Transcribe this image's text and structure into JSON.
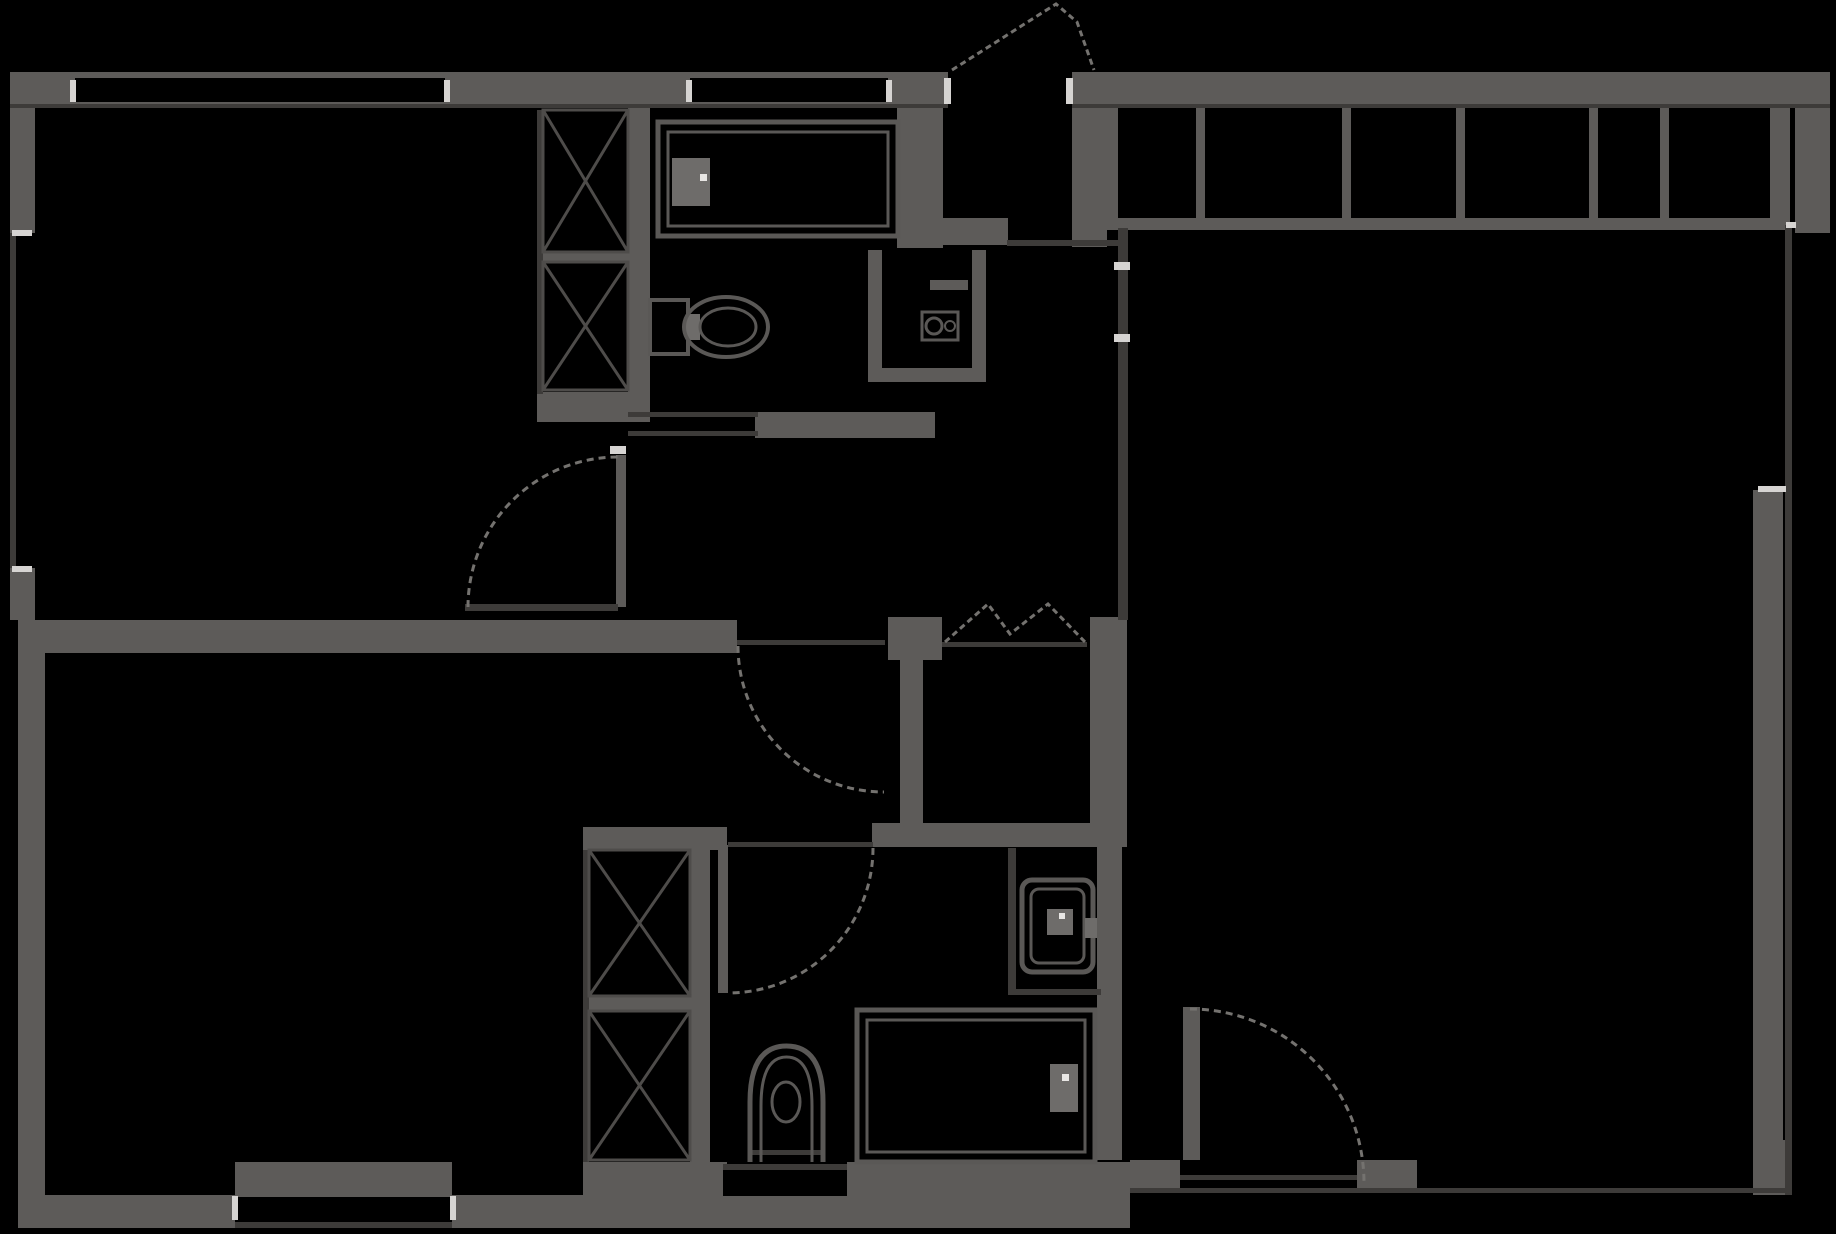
{
  "canvas": {
    "width": 1836,
    "height": 1234,
    "background": "#000000"
  },
  "palette": {
    "bg": "#000000",
    "wall": "#5d5b59",
    "line": "#3d3b39",
    "dash": "#74726f",
    "tick": "#d6d4d2",
    "fix": "#5a5856",
    "fixFill": "#6e6c6a",
    "dot": "#e8e6e4"
  },
  "elements": [
    {
      "name": "top-wall",
      "kind": "wall",
      "r": [
        10,
        72,
        1820,
        36
      ]
    },
    {
      "name": "left-wall-upper",
      "kind": "wall",
      "r": [
        10,
        72,
        25,
        161
      ]
    },
    {
      "name": "left-wall-mid",
      "kind": "wall",
      "r": [
        10,
        568,
        25,
        52
      ]
    },
    {
      "name": "left-wall-lower",
      "kind": "wall",
      "r": [
        18,
        620,
        27,
        608
      ]
    },
    {
      "name": "right-wall-upper",
      "kind": "wall",
      "r": [
        1795,
        72,
        35,
        161
      ]
    },
    {
      "name": "right-wall-lower",
      "kind": "wall",
      "r": [
        1753,
        490,
        30,
        705
      ]
    },
    {
      "name": "bottom-wall-left",
      "kind": "wall",
      "r": [
        18,
        1195,
        217,
        33
      ]
    },
    {
      "name": "bottom-wall-window-band",
      "kind": "wall",
      "r": [
        235,
        1162,
        217,
        35
      ]
    },
    {
      "name": "bottom-wall-2",
      "kind": "wall",
      "r": [
        452,
        1195,
        131,
        33
      ]
    },
    {
      "name": "bottom-wall-closet-band",
      "kind": "wall",
      "r": [
        583,
        1162,
        144,
        66
      ]
    },
    {
      "name": "bottom-wall-under-bath-window",
      "kind": "wall",
      "r": [
        723,
        1196,
        124,
        32
      ]
    },
    {
      "name": "bottom-wall-3",
      "kind": "wall",
      "r": [
        847,
        1162,
        283,
        66
      ]
    },
    {
      "name": "patio-block-left",
      "kind": "wall",
      "r": [
        1130,
        1160,
        50,
        33
      ]
    },
    {
      "name": "patio-block-right",
      "kind": "wall",
      "r": [
        1357,
        1160,
        60,
        33
      ]
    },
    {
      "name": "bottom-corner-right",
      "kind": "wall",
      "r": [
        1753,
        1140,
        37,
        55
      ]
    },
    {
      "name": "mid-dividing-wall",
      "kind": "wall",
      "r": [
        35,
        620,
        702,
        33
      ]
    },
    {
      "name": "closet-top-left-bottom-wall",
      "kind": "wall",
      "r": [
        537,
        392,
        100,
        30
      ]
    },
    {
      "name": "bath-top-left-wall",
      "kind": "wall",
      "r": [
        628,
        108,
        22,
        314
      ]
    },
    {
      "name": "bath-top-right-wall",
      "kind": "wall",
      "r": [
        897,
        108,
        46,
        140
      ]
    },
    {
      "name": "bath-top-bottom-wall",
      "kind": "wall",
      "r": [
        755,
        412,
        180,
        26
      ]
    },
    {
      "name": "vestibule-left-wall",
      "kind": "wall",
      "r": [
        930,
        98,
        13,
        147
      ]
    },
    {
      "name": "vestibule-right-wall",
      "kind": "wall",
      "r": [
        1072,
        85,
        35,
        162
      ]
    },
    {
      "name": "vestibule-bottom-wall",
      "kind": "wall",
      "r": [
        930,
        218,
        78,
        27
      ]
    },
    {
      "name": "closet-row-bottom-wall",
      "kind": "wall",
      "r": [
        1107,
        218,
        683,
        12
      ]
    },
    {
      "name": "closet-row-left-edge",
      "kind": "wall",
      "r": [
        1107,
        108,
        11,
        112
      ]
    },
    {
      "name": "closet-row-divider-1",
      "kind": "wall",
      "r": [
        1196,
        108,
        9,
        112
      ]
    },
    {
      "name": "closet-row-divider-2",
      "kind": "wall",
      "r": [
        1342,
        108,
        9,
        112
      ]
    },
    {
      "name": "closet-row-divider-3",
      "kind": "wall",
      "r": [
        1456,
        108,
        9,
        112
      ]
    },
    {
      "name": "closet-row-divider-4",
      "kind": "wall",
      "r": [
        1589,
        108,
        9,
        112
      ]
    },
    {
      "name": "closet-row-divider-5",
      "kind": "wall",
      "r": [
        1660,
        108,
        9,
        112
      ]
    },
    {
      "name": "closet-row-end-block",
      "kind": "wall",
      "r": [
        1770,
        108,
        20,
        112
      ]
    },
    {
      "name": "wc-left-wall",
      "kind": "wall",
      "r": [
        868,
        250,
        14,
        132
      ]
    },
    {
      "name": "wc-right-wall",
      "kind": "wall",
      "r": [
        972,
        250,
        14,
        132
      ]
    },
    {
      "name": "wc-bottom-wall",
      "kind": "wall",
      "r": [
        868,
        368,
        118,
        14
      ]
    },
    {
      "name": "wc-top-stub",
      "kind": "wall",
      "r": [
        930,
        280,
        38,
        10
      ]
    },
    {
      "name": "wic-left-wall",
      "kind": "wall",
      "r": [
        900,
        617,
        23,
        230
      ]
    },
    {
      "name": "wic-top-left-block",
      "kind": "wall",
      "r": [
        888,
        617,
        54,
        43
      ]
    },
    {
      "name": "wic-right-wall",
      "kind": "wall",
      "r": [
        1090,
        617,
        37,
        230
      ]
    },
    {
      "name": "center-divider-lower",
      "kind": "wall",
      "r": [
        1097,
        847,
        25,
        313
      ]
    },
    {
      "name": "closet-lower-top-wall",
      "kind": "wall",
      "r": [
        583,
        827,
        144,
        23
      ]
    },
    {
      "name": "closet-lower-right-wall",
      "kind": "wall",
      "r": [
        690,
        850,
        20,
        312
      ]
    },
    {
      "name": "wic-bottom-wall",
      "kind": "wall",
      "r": [
        872,
        823,
        248,
        24
      ]
    },
    {
      "name": "closet-top-divider",
      "kind": "wall",
      "r": [
        543,
        252,
        85,
        10
      ]
    },
    {
      "name": "closet-lower-divider",
      "kind": "wall",
      "r": [
        589,
        996,
        101,
        15
      ]
    },
    {
      "name": "bedroom1-door-jamb",
      "kind": "wall",
      "r": [
        616,
        455,
        10,
        152
      ]
    },
    {
      "name": "bath-lower-door-leaf",
      "kind": "wall",
      "r": [
        718,
        845,
        10,
        148
      ]
    },
    {
      "name": "patio-door-leaf",
      "kind": "wall",
      "r": [
        1183,
        1007,
        17,
        176
      ]
    },
    {
      "name": "top-window-left-slot",
      "kind": "slot",
      "r": [
        75,
        78,
        370,
        24
      ]
    },
    {
      "name": "top-window-bath-slot",
      "kind": "slot",
      "r": [
        690,
        78,
        198,
        24
      ]
    },
    {
      "name": "entry-door-opening",
      "kind": "slot",
      "r": [
        948,
        72,
        124,
        36
      ]
    },
    {
      "name": "left-window-slot",
      "kind": "slot",
      "r": [
        16,
        233,
        19,
        335
      ]
    },
    {
      "name": "bottom-window-left-slot",
      "kind": "slot",
      "r": [
        235,
        1197,
        217,
        25
      ]
    },
    {
      "name": "bath-bottom-window-slot",
      "kind": "slot",
      "r": [
        723,
        1170,
        124,
        26
      ]
    },
    {
      "name": "patio-door-opening",
      "kind": "slot",
      "r": [
        1180,
        1160,
        177,
        33
      ]
    },
    {
      "name": "top-wall-inner-line-left",
      "kind": "tline",
      "r": [
        10,
        104,
        938,
        4
      ]
    },
    {
      "name": "top-wall-inner-line-right",
      "kind": "tline",
      "r": [
        1072,
        104,
        758,
        4
      ]
    },
    {
      "name": "left-window-glass-line",
      "kind": "tline",
      "r": [
        10,
        233,
        6,
        335
      ]
    },
    {
      "name": "closet-top-left-line",
      "kind": "tline",
      "r": [
        537,
        110,
        6,
        284
      ]
    },
    {
      "name": "closet-lower-left-line",
      "kind": "tline",
      "r": [
        583,
        850,
        6,
        312
      ]
    },
    {
      "name": "vestibule-hall-line",
      "kind": "tline",
      "r": [
        1007,
        240,
        116,
        6
      ]
    },
    {
      "name": "hall-livingroom-divider-line",
      "kind": "tline",
      "r": [
        1118,
        228,
        10,
        392
      ]
    },
    {
      "name": "wic-bifold-head-line",
      "kind": "tline",
      "r": [
        942,
        642,
        145,
        5
      ]
    },
    {
      "name": "hall-door-head-line",
      "kind": "tline",
      "r": [
        737,
        640,
        148,
        5
      ]
    },
    {
      "name": "bath-lower-door-threshold",
      "kind": "tline",
      "r": [
        728,
        842,
        145,
        5
      ]
    },
    {
      "name": "toilet-nook-left-line",
      "kind": "tline",
      "r": [
        1008,
        848,
        8,
        147
      ]
    },
    {
      "name": "toilet-nook-bottom-line",
      "kind": "tline",
      "r": [
        1016,
        989,
        85,
        6
      ]
    },
    {
      "name": "right-window-glass-line",
      "kind": "tline",
      "r": [
        1785,
        225,
        7,
        970
      ]
    },
    {
      "name": "bottom-right-glass-line",
      "kind": "tline",
      "r": [
        1130,
        1188,
        660,
        5
      ]
    },
    {
      "name": "patio-door-track-line",
      "kind": "tline",
      "r": [
        1180,
        1175,
        177,
        5
      ]
    },
    {
      "name": "bottom-window-left-outer-line",
      "kind": "tline",
      "r": [
        235,
        1222,
        217,
        6
      ]
    },
    {
      "name": "bath-bottom-window-top-line",
      "kind": "tline",
      "r": [
        723,
        1164,
        124,
        6
      ]
    },
    {
      "name": "bedroom1-door-leaf-line",
      "kind": "tline",
      "r": [
        465,
        604,
        153,
        7
      ]
    },
    {
      "name": "bath-top-sliding-door-line-a",
      "kind": "tline",
      "r": [
        628,
        412,
        130,
        5
      ]
    },
    {
      "name": "bath-top-sliding-door-line-b",
      "kind": "tline",
      "r": [
        628,
        431,
        130,
        5
      ]
    },
    {
      "name": "entry-jamb-tick-left",
      "kind": "tick",
      "r": [
        944,
        78,
        7,
        26
      ]
    },
    {
      "name": "entry-jamb-tick-right",
      "kind": "tick",
      "r": [
        1066,
        78,
        7,
        26
      ]
    },
    {
      "name": "top-window-tick-left",
      "kind": "tick",
      "r": [
        70,
        80,
        6,
        22
      ]
    },
    {
      "name": "top-window-tick-right",
      "kind": "tick",
      "r": [
        444,
        80,
        6,
        22
      ]
    },
    {
      "name": "bath-window-tick-left",
      "kind": "tick",
      "r": [
        686,
        80,
        6,
        22
      ]
    },
    {
      "name": "bath-window-tick-right",
      "kind": "tick",
      "r": [
        886,
        80,
        6,
        22
      ]
    },
    {
      "name": "left-window-tick-top",
      "kind": "tick",
      "r": [
        12,
        230,
        20,
        6
      ]
    },
    {
      "name": "left-window-tick-bottom",
      "kind": "tick",
      "r": [
        12,
        566,
        20,
        6
      ]
    },
    {
      "name": "right-window-tick-top",
      "kind": "tick",
      "r": [
        1786,
        222,
        10,
        6
      ]
    },
    {
      "name": "right-window-tick-bottom",
      "kind": "tick",
      "r": [
        1758,
        486,
        28,
        6
      ]
    },
    {
      "name": "bottom-window-tick-left",
      "kind": "tick",
      "r": [
        232,
        1196,
        6,
        24
      ]
    },
    {
      "name": "bottom-window-tick-right",
      "kind": "tick",
      "r": [
        450,
        1196,
        6,
        24
      ]
    },
    {
      "name": "bedroom1-door-jamb-tick",
      "kind": "tick",
      "r": [
        610,
        446,
        16,
        8
      ]
    },
    {
      "name": "divider-tick-1",
      "kind": "tick",
      "r": [
        1114,
        262,
        16,
        8
      ]
    },
    {
      "name": "divider-tick-2",
      "kind": "tick",
      "r": [
        1114,
        334,
        16,
        8
      ]
    },
    {
      "name": "closet-top-xbox-upper",
      "kind": "xcell",
      "r": [
        543,
        110,
        85,
        142
      ]
    },
    {
      "name": "closet-top-xbox-lower",
      "kind": "xcell",
      "r": [
        543,
        262,
        85,
        128
      ]
    },
    {
      "name": "closet-lower-xbox-upper",
      "kind": "xcell",
      "r": [
        589,
        850,
        101,
        146
      ]
    },
    {
      "name": "closet-lower-xbox-lower",
      "kind": "xcell",
      "r": [
        589,
        1011,
        101,
        149
      ]
    },
    {
      "name": "bedroom1-door-swing-arc",
      "kind": "arc",
      "x1": 468,
      "y1": 607,
      "x2": 618,
      "y2": 457,
      "radius": 150,
      "sweep": 1
    },
    {
      "name": "hall-door-swing-arc",
      "kind": "arc",
      "x1": 738,
      "y1": 646,
      "x2": 884,
      "y2": 792,
      "radius": 146,
      "sweep": 0
    },
    {
      "name": "bath-lower-door-swing-arc",
      "kind": "arc",
      "x1": 873,
      "y1": 848,
      "x2": 728,
      "y2": 993,
      "radius": 145,
      "sweep": 1
    },
    {
      "name": "patio-door-swing-arc",
      "kind": "arc",
      "x1": 1190,
      "y1": 1009,
      "x2": 1364,
      "y2": 1183,
      "radius": 174,
      "sweep": 1
    },
    {
      "name": "entry-door-swing-lines",
      "kind": "zig",
      "pts": [
        [
          952,
          70
        ],
        [
          1056,
          4
        ],
        [
          1077,
          22
        ],
        [
          1094,
          70
        ]
      ]
    },
    {
      "name": "wic-bifold-door-lines",
      "kind": "zig",
      "pts": [
        [
          945,
          642
        ],
        [
          988,
          604
        ],
        [
          1010,
          634
        ],
        [
          1048,
          604
        ],
        [
          1085,
          642
        ]
      ]
    },
    {
      "name": "bathtub-top",
      "kind": "orect",
      "r": [
        658,
        122,
        240,
        114
      ],
      "sw": 5
    },
    {
      "name": "bathtub-top-inner",
      "kind": "orect",
      "r": [
        668,
        132,
        220,
        94
      ],
      "sw": 3
    },
    {
      "name": "bathtub-top-faucet",
      "kind": "fill",
      "r": [
        672,
        158,
        38,
        48
      ]
    },
    {
      "name": "bathtub-top-faucet-dot",
      "kind": "dot",
      "r": [
        700,
        174,
        7,
        7
      ]
    },
    {
      "name": "toilet-top-tank",
      "kind": "orect",
      "r": [
        650,
        300,
        38,
        54
      ],
      "sw": 4
    },
    {
      "name": "toilet-top-joint",
      "kind": "fill",
      "r": [
        686,
        314,
        14,
        26
      ]
    },
    {
      "name": "toilet-top-bowl",
      "kind": "oellipse",
      "cx": 726,
      "cy": 327,
      "rx": 42,
      "ry": 30,
      "sw": 4
    },
    {
      "name": "toilet-top-bowl-inner",
      "kind": "oellipse",
      "cx": 728,
      "cy": 327,
      "rx": 28,
      "ry": 19,
      "sw": 3
    },
    {
      "name": "washer-box",
      "kind": "orect",
      "r": [
        922,
        312,
        36,
        28
      ],
      "sw": 3
    },
    {
      "name": "washer-drum",
      "kind": "oellipse",
      "cx": 934,
      "cy": 326,
      "rx": 8,
      "ry": 8,
      "sw": 3
    },
    {
      "name": "washer-knob",
      "kind": "oellipse",
      "cx": 950,
      "cy": 326,
      "rx": 5,
      "ry": 5,
      "sw": 2
    },
    {
      "name": "toilet-lower-body",
      "kind": "orect",
      "r": [
        1022,
        880,
        71,
        92
      ],
      "sw": 5,
      "rx": 10
    },
    {
      "name": "toilet-lower-seat",
      "kind": "orect",
      "r": [
        1031,
        889,
        53,
        74
      ],
      "sw": 3,
      "rx": 8
    },
    {
      "name": "toilet-lower-button",
      "kind": "fill",
      "r": [
        1047,
        909,
        26,
        26
      ]
    },
    {
      "name": "toilet-lower-dot",
      "kind": "dot",
      "r": [
        1059,
        913,
        6,
        6
      ]
    },
    {
      "name": "toilet-lower-outlet",
      "kind": "fill",
      "r": [
        1085,
        918,
        12,
        20
      ]
    },
    {
      "name": "bathtub-lower",
      "kind": "orect",
      "r": [
        857,
        1010,
        238,
        152
      ],
      "sw": 5
    },
    {
      "name": "bathtub-lower-inner",
      "kind": "orect",
      "r": [
        867,
        1020,
        218,
        132
      ],
      "sw": 3
    },
    {
      "name": "bathtub-lower-faucet",
      "kind": "fill",
      "r": [
        1050,
        1064,
        28,
        48
      ]
    },
    {
      "name": "bathtub-lower-faucet-dot",
      "kind": "dot",
      "r": [
        1062,
        1074,
        7,
        7
      ]
    },
    {
      "name": "pedestal-sink-outer",
      "kind": "path",
      "d": "M750 1162 V1102 Q750 1046 786.5 1046 Q823 1046 823 1102 V1162",
      "sw": 5
    },
    {
      "name": "pedestal-sink-inner",
      "kind": "path",
      "d": "M761 1162 V1106 Q761 1057 786.5 1057 Q812 1057 812 1106 V1162",
      "sw": 3
    },
    {
      "name": "pedestal-sink-basin",
      "kind": "oellipse",
      "cx": 786,
      "cy": 1102,
      "rx": 14,
      "ry": 20,
      "sw": 3
    },
    {
      "name": "pedestal-sink-base-line",
      "kind": "tline",
      "r": [
        750,
        1150,
        73,
        5
      ]
    }
  ]
}
